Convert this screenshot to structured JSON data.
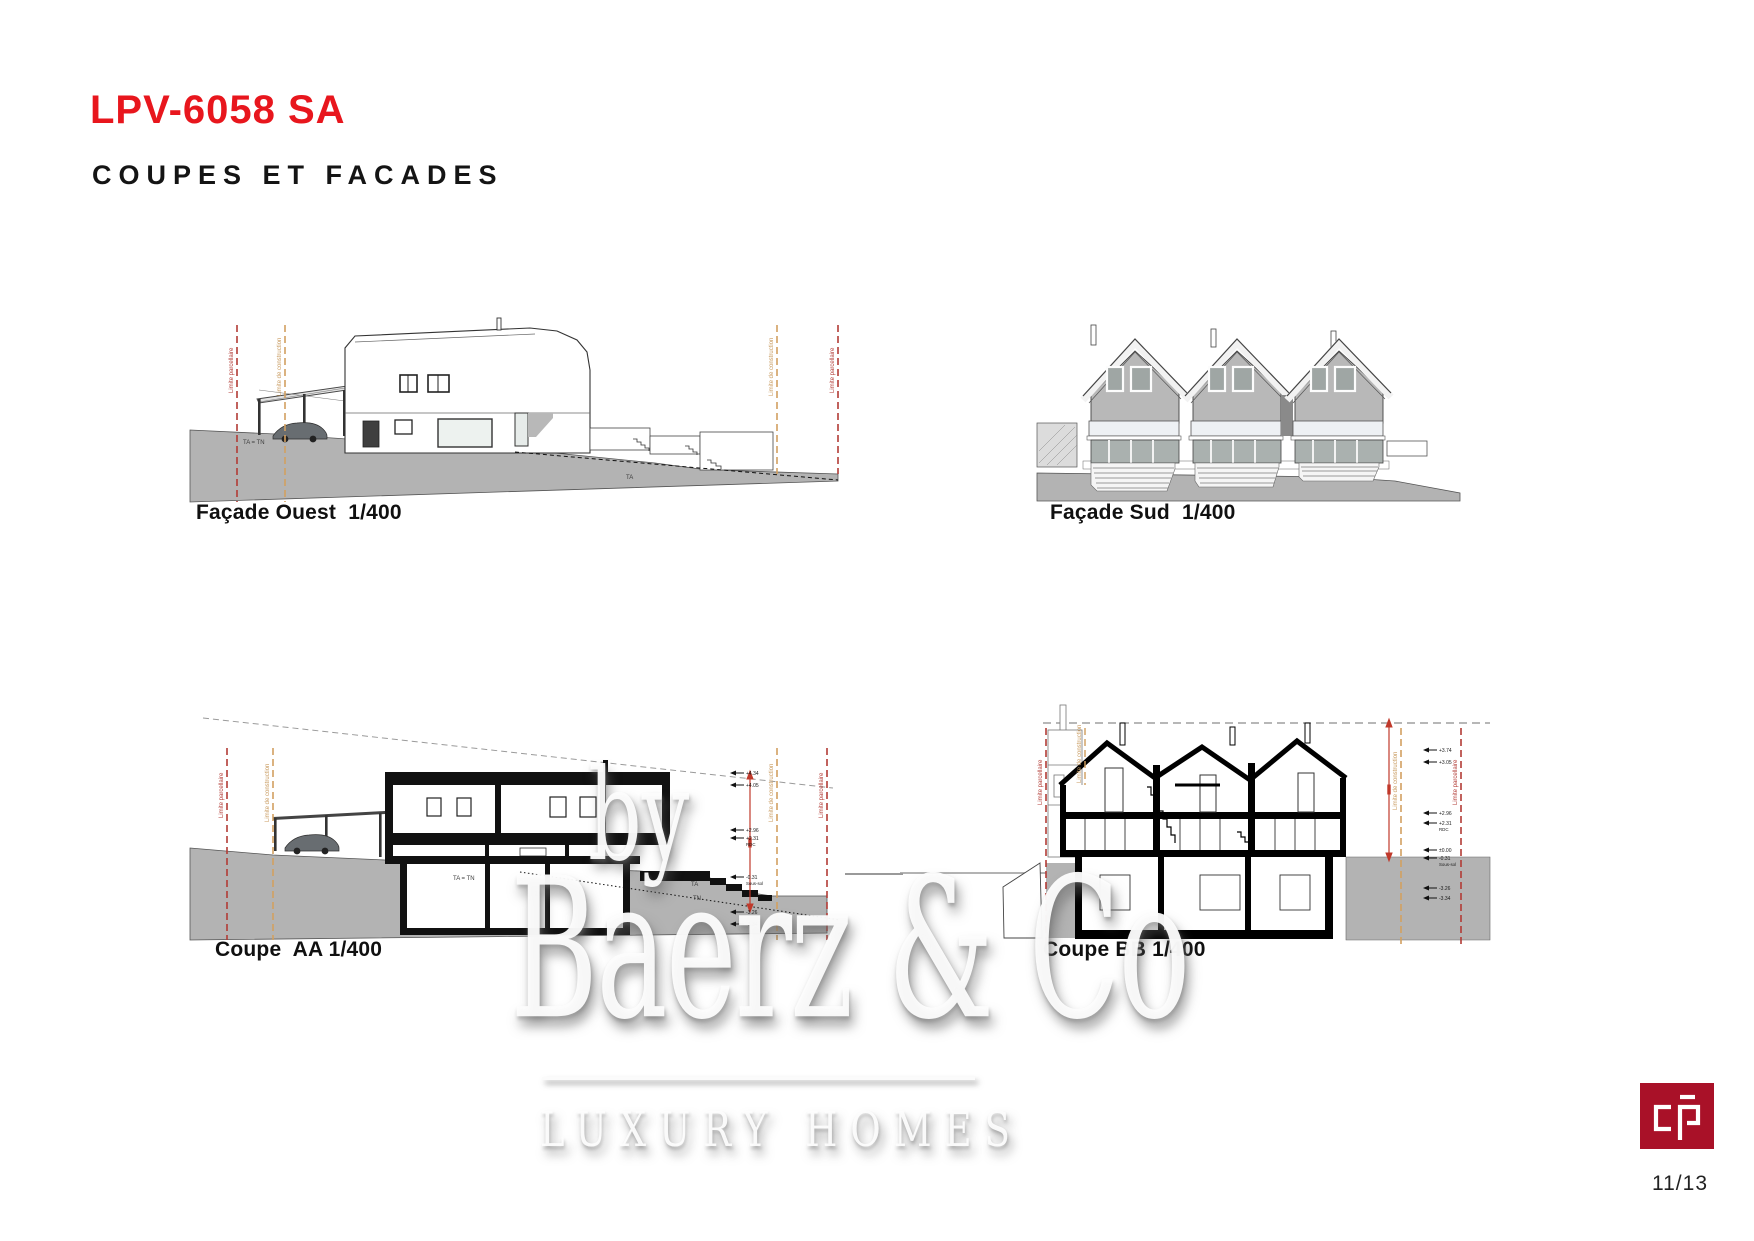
{
  "page": {
    "title": "LPV-6058 SA",
    "subtitle": "COUPES ET FACADES",
    "page_number": "11/13"
  },
  "drawings": {
    "facade_ouest": {
      "caption": "Façade Ouest  1/400"
    },
    "facade_sud": {
      "caption": "Façade Sud  1/400"
    },
    "coupe_aa": {
      "caption": "Coupe  AA 1/400"
    },
    "coupe_bb": {
      "caption": "Coupe BB 1/400"
    }
  },
  "annotations": {
    "limite_parcellaire": "Limite parcellaire",
    "limite_construction": "Limite de construction",
    "ta_tn": "TA = TN",
    "ta": "TA",
    "tn": "TN",
    "rdc": "RDC",
    "sous_sol": "Sous-sol"
  },
  "elevations": {
    "coupe_aa": [
      "+4.34",
      "+4.05",
      "+2.96",
      "+2.31",
      "-0.31",
      "-3.26",
      "-3.34"
    ],
    "coupe_bb": [
      "+3.74",
      "+3.05",
      "+2.96",
      "+2.31",
      "±0.00",
      "-0.31",
      "-3.26",
      "-3.34"
    ]
  },
  "watermark": {
    "by": "by",
    "brand": "Baerz & Co",
    "tagline": "LUXURY HOMES"
  },
  "colors": {
    "accent_red": "#e8161d",
    "limit_red": "#b23b35",
    "limit_orange": "#d2a060",
    "terrain_gray": "#b3b3b3",
    "logo_red": "#a91128"
  }
}
